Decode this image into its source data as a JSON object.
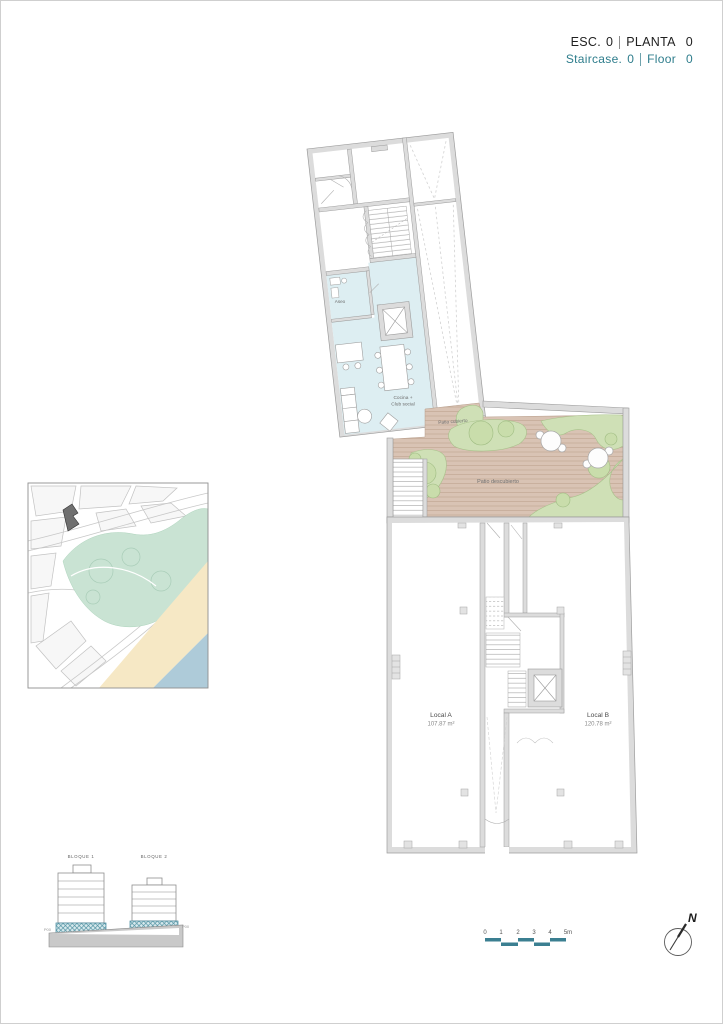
{
  "header": {
    "esc_label": "ESC.",
    "esc_value": "0",
    "planta_label": "PLANTA",
    "planta_value": "0",
    "staircase_label": "Staircase.",
    "staircase_value": "0",
    "floor_label": "Floor",
    "floor_value": "0",
    "title_color": "#1f1f1f",
    "subtitle_color": "#2e7d8c"
  },
  "floor_plan": {
    "rooms": {
      "aseo": "Aseo",
      "cocina_line1": "Cocina +",
      "cocina_line2": "Club social",
      "patio_cubierto": "Patio cubierto",
      "patio_descubierto": "Patio descubierto",
      "local_a": {
        "name": "Local A",
        "area": "107.87 m²"
      },
      "local_b": {
        "name": "Local B",
        "area": "120.78 m²"
      }
    },
    "colors": {
      "wall_fill": "#dcdcdc",
      "wall_line": "#9c9c9c",
      "club_room_fill": "#ddeef2",
      "patio_floor": "#d9c3b4",
      "patio_stripe": "#c8ae9c",
      "landscape_fill": "#cfe0b6",
      "landscape_line": "#a8c28b"
    }
  },
  "site_map": {
    "colors": {
      "park": "#c9e3d3",
      "sand": "#f6e8c5",
      "water": "#aecbd9",
      "subject_building": "#707070"
    }
  },
  "elevation": {
    "bloque1": "BLOQUE 1",
    "bloque2": "BLOQUE 2",
    "level_left": "P00",
    "level_right": "P00",
    "highlight_fill": "#d7e9ed",
    "highlight_line": "#4b8e9e"
  },
  "scale_bar": {
    "ticks": [
      "0",
      "1",
      "2",
      "3",
      "4",
      "5m"
    ],
    "bar_color": "#3b7f91"
  },
  "compass": {
    "north": "N"
  }
}
